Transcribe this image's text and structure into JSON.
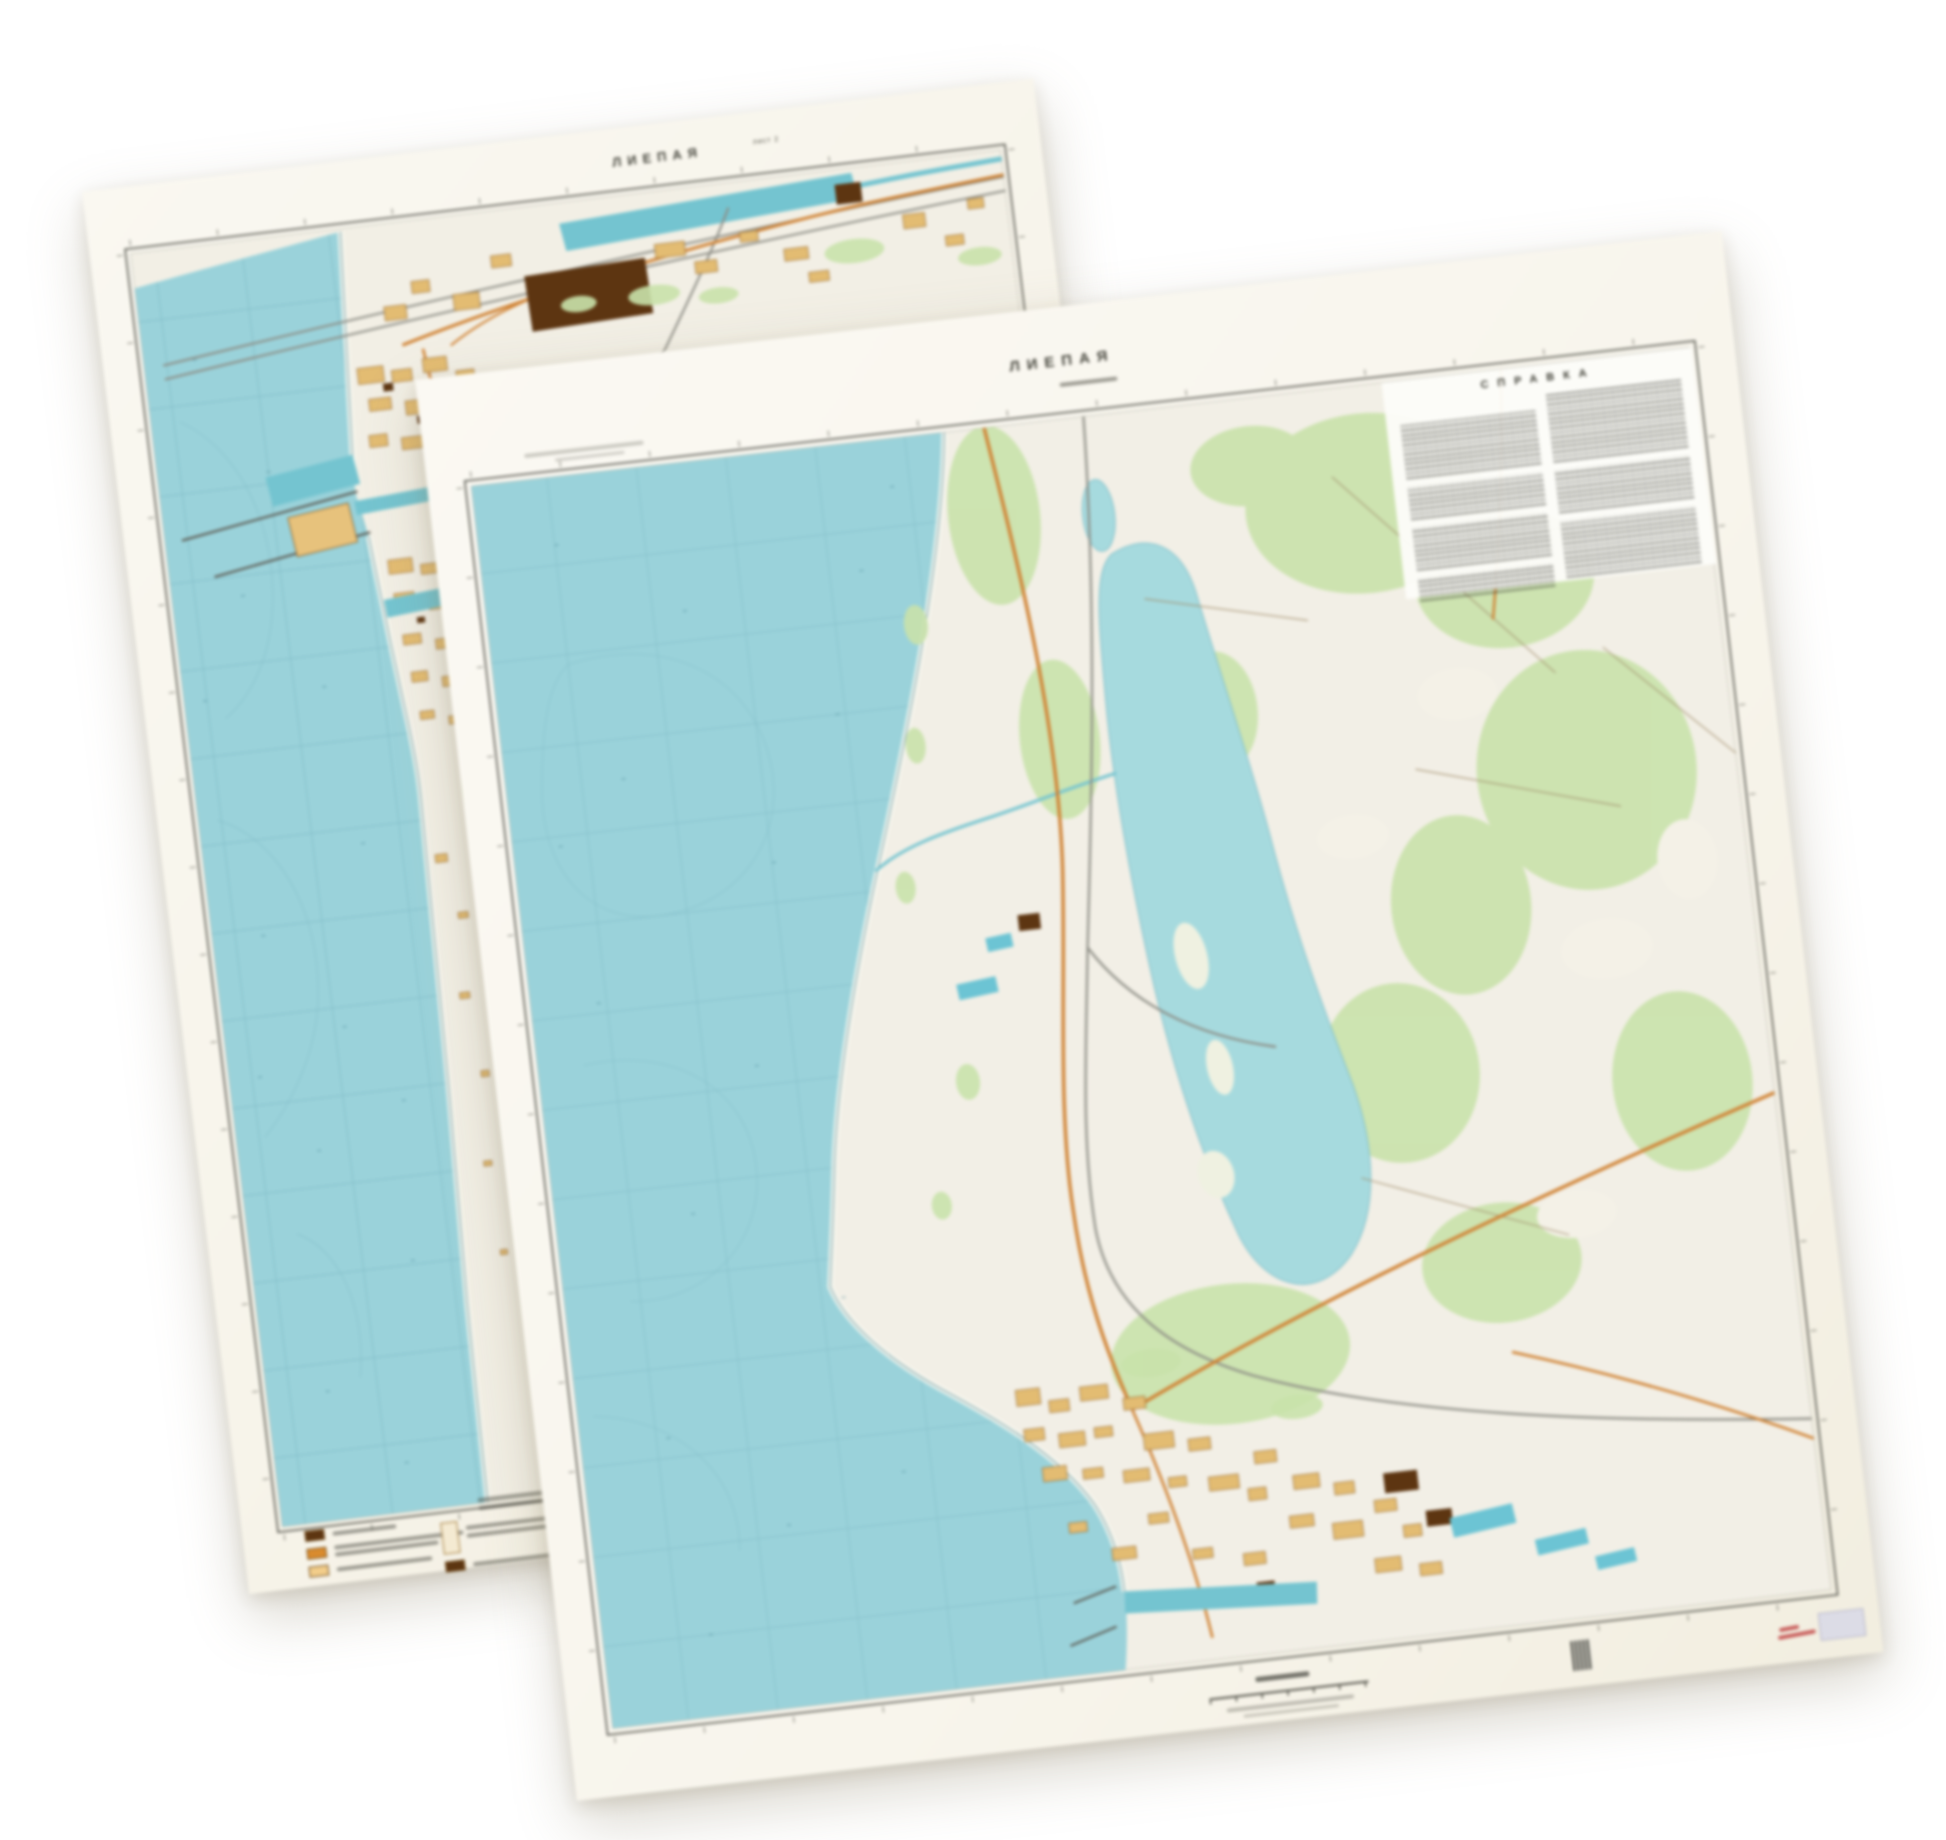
{
  "photo": {
    "description": "Two overlapping paper topographic map sheets of the city of Liepaja, slightly rotated on a white background",
    "background_color": "#ffffff"
  },
  "back_sheet": {
    "title": "ЛИЕПАЯ",
    "sheet_note": "лист 2",
    "features": "coastal city with harbor breakwaters, sea with graticule grid at left, city blocks strip along shore, rail yards and large dark building block at top",
    "colors": {
      "paper": "#f7f4ea",
      "sea": "#9ad2da",
      "land": "#f2efe5",
      "forest": "#c9e2ab",
      "city_block": "#e3bc72",
      "dark_block": "#5d3511",
      "road": "#d08233",
      "rail": "#8d8d85",
      "harbor_water": "#74c4d0"
    },
    "legend": {
      "swatch_colors": [
        "#5d3511",
        "#d98b2e",
        "#f2cd8a",
        "#f4ead2",
        "#5d3511"
      ],
      "labels_legible": false
    }
  },
  "front_sheet": {
    "title": "ЛИЕПАЯ",
    "info_heading": "СПРАВКА",
    "info_block_legible": false,
    "features": "sea at left, coastal dune strip, large lake with islands at center-right, forests, orange highways, railway, city and docks at bottom, two-column reference text block at top right",
    "colors": {
      "paper": "#f8f5ec",
      "sea": "#9ad2da",
      "lake": "#a6dade",
      "land": "#f2efe6",
      "forest": "#c9e2ab",
      "city_block": "#e3bc72",
      "dark_block": "#5d3511",
      "road": "#d08233",
      "rail": "#8d8d85",
      "dock_water": "#6cc4d4"
    },
    "margin_marks": {
      "red_annotation": true,
      "barcode_stamp": true,
      "sticker_color": "#dcdce6"
    }
  }
}
